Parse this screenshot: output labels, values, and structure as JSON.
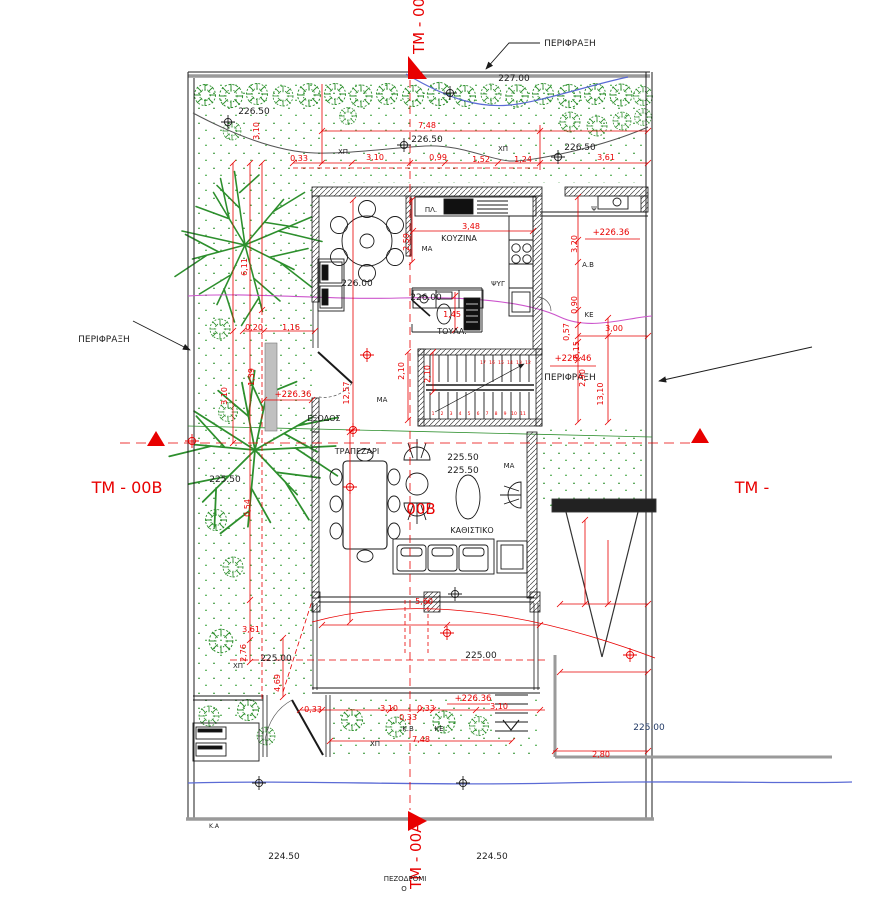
{
  "drawing": {
    "kind": "architectural site / ground-floor plan",
    "language": "Greek"
  },
  "palette": {
    "dimension_red": "#e80000",
    "tree_green": "#2d8f2d",
    "contour_blue": "#5b6bd5",
    "contour_magenta": "#cc55cc",
    "contour_gray": "#555555",
    "fence_gray": "#9a9a9a",
    "text_black": "#1c1c1c",
    "navy_text": "#223a66"
  },
  "annotations": {
    "section_markers": {
      "color": "#e80000",
      "size": 15,
      "items": [
        {
          "name": "tm-00a-top",
          "text": "TM - 00A",
          "x": 424,
          "y": 54,
          "rotate": -90,
          "anchor": "start"
        },
        {
          "name": "tm-00b-left",
          "text": "TM - 00B",
          "x": 127,
          "y": 493,
          "size": 16
        },
        {
          "name": "tm-right",
          "text": "TM -",
          "x": 752,
          "y": 493,
          "size": 16
        },
        {
          "name": "tm-00a-bottom",
          "text": "TM - 00A",
          "x": 421,
          "y": 889,
          "rotate": -90,
          "anchor": "start"
        },
        {
          "name": "tm-00b-center",
          "text": "00Β",
          "x": 421,
          "y": 514
        }
      ]
    },
    "fence_labels": {
      "color": "#1c1c1c",
      "size": 9,
      "items": [
        {
          "name": "fence-top",
          "text": "ΠΕΡΙΦΡΑΞΗ",
          "x": 570,
          "y": 46
        },
        {
          "name": "fence-left",
          "text": "ΠΕΡΙΦΡΑΞΗ",
          "x": 104,
          "y": 342
        },
        {
          "name": "fence-right",
          "text": "ΠΕΡΙΦΡΑΞΗ",
          "x": 570,
          "y": 380
        }
      ]
    },
    "room_labels": {
      "color": "#1c1c1c",
      "size": 8,
      "items": [
        {
          "name": "kitchen",
          "text": "ΚΟΥΖΙΝΑ",
          "x": 459,
          "y": 241
        },
        {
          "name": "toilet",
          "text": "ΤΟΥΑΛ.",
          "x": 452,
          "y": 334
        },
        {
          "name": "dining",
          "text": "ΤΡΑΠΕΖΑΡΙ",
          "x": 357,
          "y": 454
        },
        {
          "name": "living",
          "text": "ΚΑΘΙΣΤΙΚΟ",
          "x": 472,
          "y": 533
        },
        {
          "name": "exit",
          "text": "ΕΞΟΔΟΣ",
          "x": 324,
          "y": 421
        },
        {
          "name": "sidewalk-1",
          "text": "ΠΕΖΟΔΡΟΜΙ",
          "x": 405,
          "y": 881,
          "size": 7
        },
        {
          "name": "sidewalk-2",
          "text": "Ο",
          "x": 404,
          "y": 891,
          "size": 7
        }
      ]
    },
    "equipment_labels": {
      "color": "#1c1c1c",
      "size": 7,
      "items": [
        {
          "text": "ΠΛ.",
          "x": 431,
          "y": 212
        },
        {
          "text": "ΨΥΓ",
          "x": 498,
          "y": 286
        },
        {
          "text": "Ψ",
          "x": 594,
          "y": 211
        },
        {
          "text": "Α.Β",
          "x": 588,
          "y": 267
        },
        {
          "text": "ΚΕ",
          "x": 589,
          "y": 317
        },
        {
          "text": "ΚΕ",
          "x": 439,
          "y": 731
        },
        {
          "text": "Κ.Β",
          "x": 408,
          "y": 731
        },
        {
          "text": "Κ.Α",
          "x": 214,
          "y": 828,
          "size": 6
        },
        {
          "text": "ΜΑ",
          "x": 427,
          "y": 251
        },
        {
          "text": "ΜΑ",
          "x": 382,
          "y": 402
        },
        {
          "text": "ΜΑ",
          "x": 509,
          "y": 468
        },
        {
          "text": "ΧΠ",
          "x": 343,
          "y": 154
        },
        {
          "text": "ΧΠ",
          "x": 503,
          "y": 151
        },
        {
          "text": "ΧΠ",
          "x": 238,
          "y": 668
        },
        {
          "text": "ΧΠ",
          "x": 375,
          "y": 746
        }
      ]
    },
    "elevation_labels": {
      "color": "#1c1c1c",
      "size": 9,
      "items": [
        {
          "text": "227.00",
          "x": 514,
          "y": 81
        },
        {
          "text": "226.50",
          "x": 254,
          "y": 114
        },
        {
          "text": "226.50",
          "x": 427,
          "y": 142
        },
        {
          "text": "226.50",
          "x": 580,
          "y": 150
        },
        {
          "text": "226.00",
          "x": 357,
          "y": 286
        },
        {
          "text": "226.00",
          "x": 426,
          "y": 300
        },
        {
          "text": "225.50",
          "x": 225,
          "y": 482
        },
        {
          "text": "225.50",
          "x": 463,
          "y": 460
        },
        {
          "text": "225.50",
          "x": 463,
          "y": 473
        },
        {
          "text": "225.00",
          "x": 276,
          "y": 661
        },
        {
          "text": "225.00",
          "x": 481,
          "y": 658
        },
        {
          "text": "225.00",
          "x": 649,
          "y": 730,
          "color": "#223a66"
        },
        {
          "text": "224.50",
          "x": 284,
          "y": 859
        },
        {
          "text": "224.50",
          "x": 492,
          "y": 859
        }
      ]
    },
    "red_elevation_labels": {
      "color": "#e80000",
      "size": 8.5,
      "items": [
        {
          "text": "+226.36",
          "x": 293,
          "y": 397
        },
        {
          "text": "+226.36",
          "x": 611,
          "y": 235
        },
        {
          "text": "+226.46",
          "x": 573,
          "y": 361
        },
        {
          "text": "+226.36",
          "x": 473,
          "y": 701
        }
      ]
    },
    "dimension_labels": {
      "color": "#e80000",
      "size": 8,
      "items": [
        {
          "text": "7,48",
          "x": 427,
          "y": 128
        },
        {
          "text": "0,33",
          "x": 299,
          "y": 161
        },
        {
          "text": "3,10",
          "x": 375,
          "y": 160
        },
        {
          "text": "0,99",
          "x": 438,
          "y": 160
        },
        {
          "text": "1,52",
          "x": 481,
          "y": 162
        },
        {
          "text": "1,24",
          "x": 523,
          "y": 162
        },
        {
          "text": "3,61",
          "x": 606,
          "y": 160
        },
        {
          "text": "3,48",
          "x": 471,
          "y": 229
        },
        {
          "text": "2,59",
          "x": 409,
          "y": 242,
          "rotate": -90
        },
        {
          "text": "3,10",
          "x": 259,
          "y": 131,
          "rotate": -90
        },
        {
          "text": "6,11",
          "x": 247,
          "y": 267,
          "rotate": -90
        },
        {
          "text": "0,20",
          "x": 254,
          "y": 330
        },
        {
          "text": "1,16",
          "x": 291,
          "y": 330
        },
        {
          "text": "1,39",
          "x": 254,
          "y": 377,
          "rotate": -90
        },
        {
          "text": "3,10",
          "x": 227,
          "y": 396,
          "rotate": -90
        },
        {
          "text": "12,57",
          "x": 349,
          "y": 393,
          "rotate": -90
        },
        {
          "text": "2,10",
          "x": 404,
          "y": 371,
          "rotate": -90
        },
        {
          "text": "2,10",
          "x": 430,
          "y": 374,
          "rotate": -90
        },
        {
          "text": "1,45",
          "x": 452,
          "y": 317
        },
        {
          "text": "3,20",
          "x": 577,
          "y": 244,
          "rotate": -90
        },
        {
          "text": "0,90",
          "x": 577,
          "y": 305,
          "rotate": -90
        },
        {
          "text": "0,57",
          "x": 569,
          "y": 332,
          "rotate": -90
        },
        {
          "text": "6,15",
          "x": 579,
          "y": 350,
          "rotate": -90
        },
        {
          "text": "2,90",
          "x": 585,
          "y": 378,
          "rotate": -90
        },
        {
          "text": "13,10",
          "x": 603,
          "y": 394,
          "rotate": -90
        },
        {
          "text": "3,00",
          "x": 614,
          "y": 331
        },
        {
          "text": "0,54",
          "x": 250,
          "y": 508,
          "rotate": -90
        },
        {
          "text": "3,61",
          "x": 251,
          "y": 632
        },
        {
          "text": "2,76",
          "x": 246,
          "y": 653,
          "rotate": -90
        },
        {
          "text": "4,69",
          "x": 280,
          "y": 683,
          "rotate": -90
        },
        {
          "text": "0,33",
          "x": 313,
          "y": 712
        },
        {
          "text": "3,10",
          "x": 389,
          "y": 711
        },
        {
          "text": "0,33",
          "x": 426,
          "y": 711
        },
        {
          "text": "0,33",
          "x": 408,
          "y": 720
        },
        {
          "text": "3,10",
          "x": 499,
          "y": 709
        },
        {
          "text": "7,48",
          "x": 421,
          "y": 742
        },
        {
          "text": "5,60",
          "x": 424,
          "y": 604
        },
        {
          "text": "2,80",
          "x": 601,
          "y": 757
        }
      ]
    },
    "stair_numbers": {
      "color": "#e80000",
      "size": 4.5,
      "items": [
        {
          "text": "1",
          "x": 433,
          "y": 415
        },
        {
          "text": "2",
          "x": 442,
          "y": 415
        },
        {
          "text": "3",
          "x": 451,
          "y": 415
        },
        {
          "text": "4",
          "x": 460,
          "y": 415
        },
        {
          "text": "5",
          "x": 469,
          "y": 415
        },
        {
          "text": "6",
          "x": 478,
          "y": 415
        },
        {
          "text": "7",
          "x": 487,
          "y": 415
        },
        {
          "text": "8",
          "x": 496,
          "y": 415
        },
        {
          "text": "9",
          "x": 505,
          "y": 415
        },
        {
          "text": "10",
          "x": 514,
          "y": 415
        },
        {
          "text": "11",
          "x": 523,
          "y": 415
        },
        {
          "text": "12",
          "x": 528,
          "y": 364
        },
        {
          "text": "13",
          "x": 519,
          "y": 364
        },
        {
          "text": "14",
          "x": 510,
          "y": 364
        },
        {
          "text": "15",
          "x": 501,
          "y": 364
        },
        {
          "text": "16",
          "x": 492,
          "y": 364
        },
        {
          "text": "17",
          "x": 483,
          "y": 364
        }
      ]
    }
  }
}
